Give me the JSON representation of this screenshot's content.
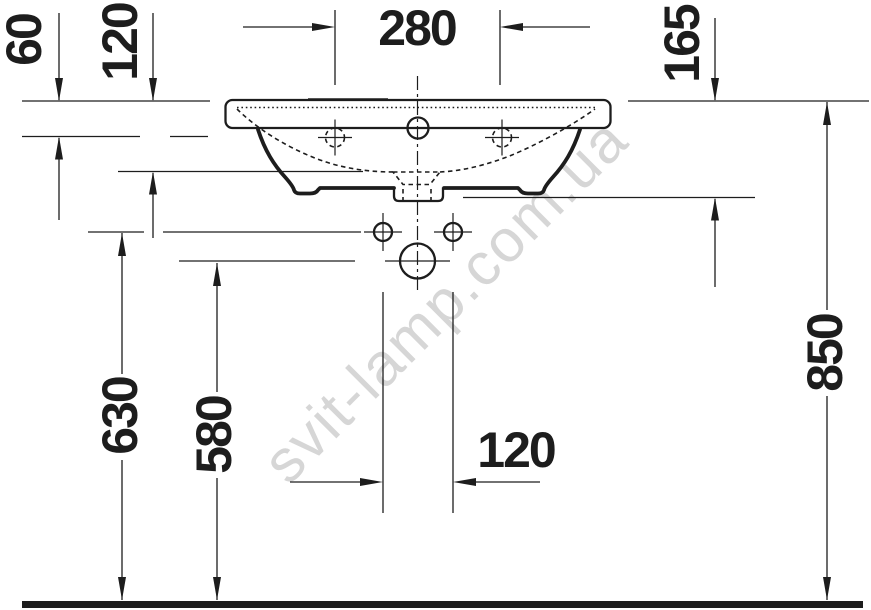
{
  "watermark": {
    "text": "svit-lamp.com.ua",
    "color": "#d6d6d6"
  },
  "drawing": {
    "subject": "wall-mounted washbasin, front elevation technical drawing",
    "line_color": "#1d1d1d",
    "dimensions": {
      "faucet_centers_width": "280",
      "rim_to_overflow_level": "60",
      "rim_to_side_bottom": "120",
      "rim_to_drain_outlet": "165",
      "floor_to_fixing_holes": "630",
      "floor_to_drain_center": "580",
      "drain_holes_spacing": "120",
      "floor_to_rim_height": "850"
    }
  }
}
